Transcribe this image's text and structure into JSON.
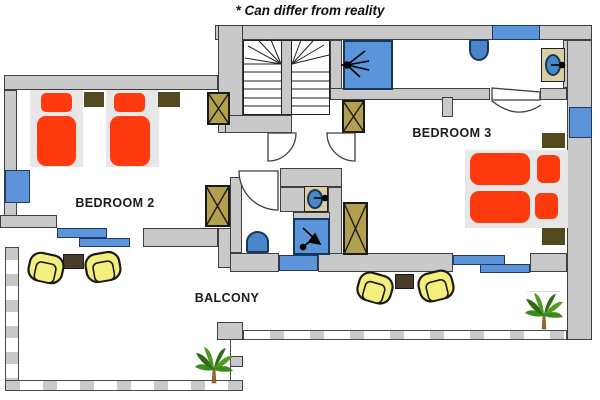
{
  "annotation": "* Can differ from reality",
  "rooms": {
    "bedroom2": {
      "label": "BEDROOM 2",
      "furniture": "two single beds, two nightstands, wardrobe"
    },
    "bedroom3": {
      "label": "BEDROOM 3",
      "furniture": "double bed, two nightstands, two wardrobes"
    },
    "balcony": {
      "label": "BALCONY",
      "furniture": "two seating sets with armchairs and tables, two palm plants"
    },
    "bathroom_top": {
      "furniture": "shower, toilet, washbasin"
    },
    "shower_room_middle": {
      "furniture": "shower, toilet, washbasin"
    }
  },
  "colors": {
    "wall": "#c9c9c9",
    "wall_outline": "#3f3f3f",
    "bed_red": "#fe3b0e",
    "bed_base": "#e7e7e7",
    "wardrobe_tan": "#b2a04f",
    "nightstand_olive": "#52491f",
    "table_brown": "#4a3c28",
    "window_blue": "#5b94d8",
    "fixture_blue": "#4a86c8",
    "fixture_outline": "#17365d",
    "chair_yellow": "#f4ef7d",
    "palm_green": "#3f8a1c",
    "sink_counter": "#d9cfa3"
  }
}
